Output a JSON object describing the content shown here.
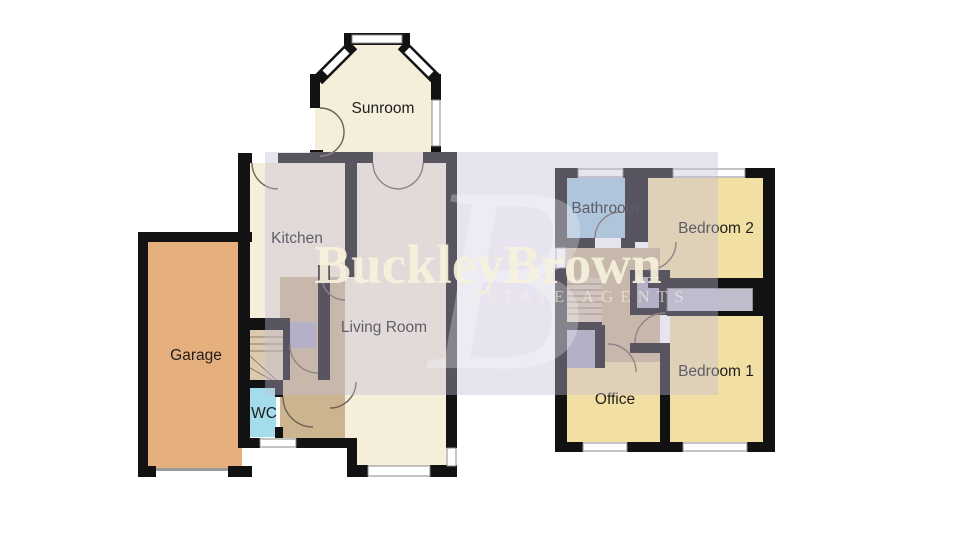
{
  "watermark": {
    "brand": "BuckleyBrown",
    "tagline": "ESTATE AGENTS",
    "monogram": "B"
  },
  "labels": {
    "sunroom": "Sunroom",
    "kitchen": "Kitchen",
    "garage": "Garage",
    "wc": "WC",
    "living_room": "Living Room",
    "bathroom": "Bathroom",
    "bedroom2": "Bedroom 2",
    "bedroom1": "Bedroom 1",
    "office": "Office"
  },
  "colors": {
    "cream": "#f5eedb",
    "yellow": "#f1dfa4",
    "orange": "#e6b07e",
    "cyan": "#a5dcec",
    "blue": "#a2cbe0",
    "tan": "#ccb48e",
    "stair": "#dccaae",
    "cupboard": "#a9a9bf",
    "wardrobe": "#bdbdcb",
    "garage_door": "#9a9a9a",
    "watermark_text": "#f7f1dd",
    "watermark_fill": "rgba(196,188,216,0.40)"
  }
}
